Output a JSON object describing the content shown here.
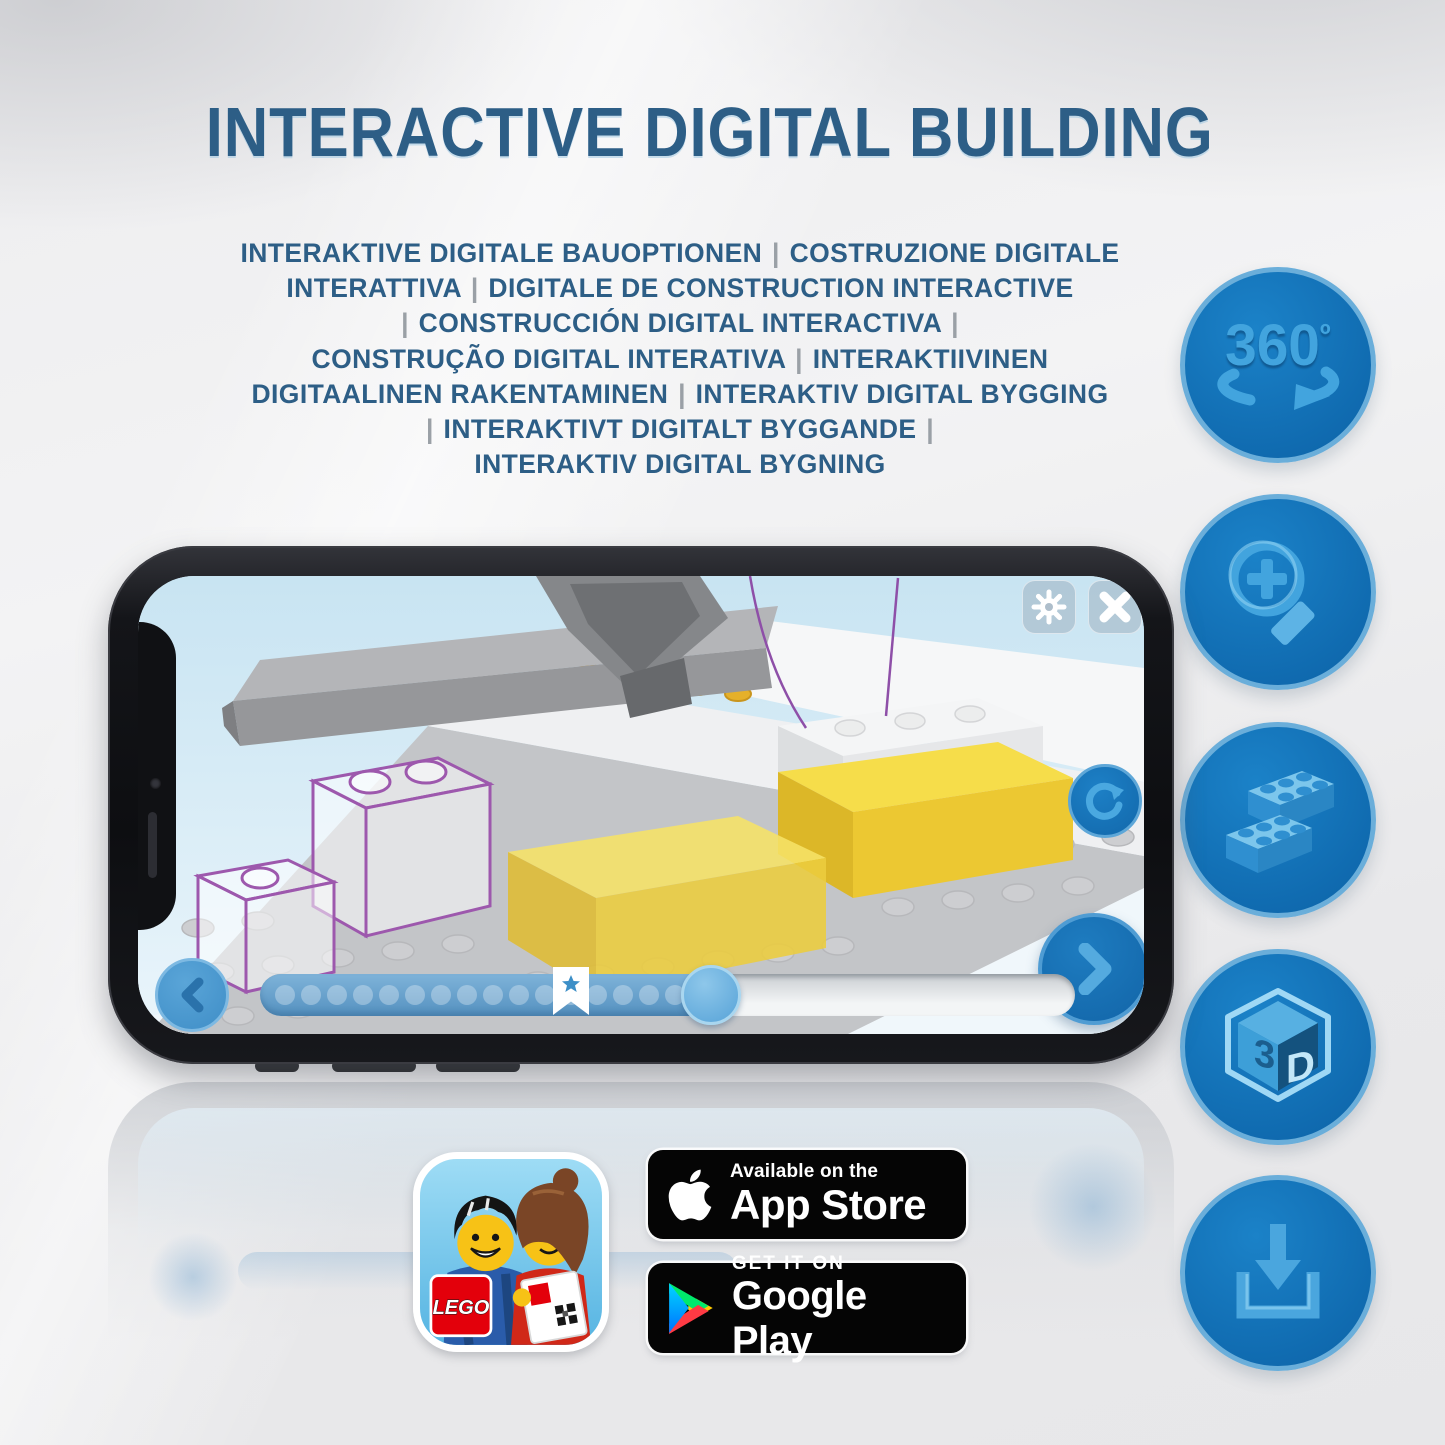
{
  "header": {
    "title": "INTERACTIVE DIGITAL BUILDING",
    "subtitle_lines": [
      "INTERAKTIVE DIGITALE BAUOPTIONEN | COSTRUZIONE DIGITALE",
      "INTERATTIVA | DIGITALE DE CONSTRUCTION INTERACTIVE",
      "| CONSTRUCCIÓN DIGITAL INTERACTIVA |",
      "CONSTRUÇÃO DIGITAL INTERATIVA | INTERAKTIIVINEN",
      "DIGITAALINEN RAKENTAMINEN | INTERAKTIV DIGITAL BYGGING",
      "| INTERAKTIVT DIGITALT BYGGANDE |",
      "INTERAKTIV DIGITAL BYGNING"
    ]
  },
  "feature_icons": [
    {
      "name": "360-rotation-icon",
      "label": "360",
      "degree": "º"
    },
    {
      "name": "zoom-in-icon"
    },
    {
      "name": "building-bricks-icon"
    },
    {
      "name": "3d-view-icon",
      "front": "3",
      "side": "D"
    },
    {
      "name": "download-icon"
    }
  ],
  "phone_app": {
    "toolbar_icons": [
      "settings-gear",
      "close-x"
    ],
    "controls": [
      "rotate-refresh",
      "previous-step",
      "next-step"
    ],
    "progress": {
      "dot_count": 17,
      "filled_percent": 58,
      "star_percent": 53,
      "thumb_percent": 70
    }
  },
  "store": {
    "lego_logo": "LEGO",
    "app_store": {
      "line1": "Available on the",
      "line2": "App Store"
    },
    "google_play": {
      "line1": "GET IT ON",
      "line2": "Google Play"
    }
  },
  "colors": {
    "title_blue": "#2d5e86",
    "icon_circle_blue": "#1373BA",
    "icon_glyph_blue": "#42A4DE",
    "brick_yellow": "#F2D841",
    "ghost_purple": "#9D58AD",
    "lego_red": "#E3000B"
  }
}
